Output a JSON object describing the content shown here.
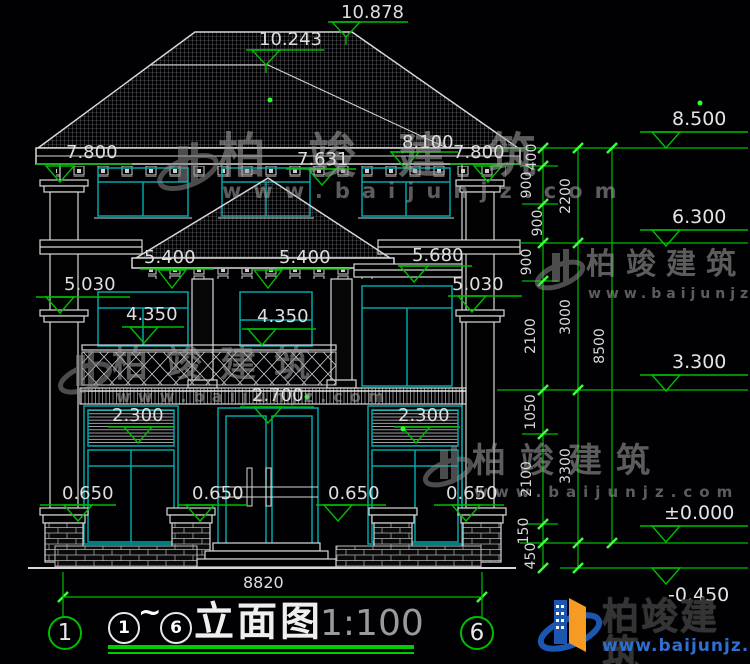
{
  "app": {
    "type": "architectural elevation CAD drawing",
    "background": "#010104"
  },
  "colors": {
    "line_white": "#d8d8d8",
    "window_frame_cyan": "#00a8a8",
    "dimension_green": "#00bd00",
    "tick_green": "#3aff3a",
    "label_white": "#dedede",
    "scale_gray": "#9a9a9a",
    "watermark_gray": "#9e9e9e",
    "logo_blue": "#1b57b0",
    "logo_orange": "#f59a23",
    "logo_url_blue": "#2e6fd0"
  },
  "marks": {
    "ridge_top": "10.878",
    "ridge_secondary": "10.243",
    "eave_left": "7.800",
    "eave_top": "8.100",
    "eave_right": "7.800",
    "porch_peak": "7.631",
    "porch_eave_left": "5.400",
    "porch_eave_right": "5.400",
    "bay_ledge": "5.680",
    "floor2_left": "5.030",
    "floor2_right": "5.030",
    "sill2_left": "4.350",
    "sill2_center": "4.350",
    "balcony": "2.700",
    "louver_left": "2.300",
    "louver_right": "2.300",
    "sill1_1": "0.650",
    "sill1_2": "0.650",
    "sill1_3": "0.650",
    "sill1_4": "0.650",
    "overall_width": "8820"
  },
  "right_dims": {
    "inner": [
      "400",
      "900",
      "900",
      "900",
      "2100",
      "1050",
      "2100",
      "150",
      "450"
    ],
    "mid": [
      "2200",
      "3000",
      "3300"
    ],
    "outer": [
      "8500"
    ],
    "levels": [
      "8.500",
      "6.300",
      "3.300",
      "±0.000",
      "-0.450"
    ]
  },
  "titleblock": {
    "axis_left": "1",
    "axis_right": "6",
    "circ_start": "1",
    "tilde": "~",
    "circ_end": "6",
    "title": "立面图",
    "scale": "1:100"
  },
  "watermark": {
    "brand": "柏竣建筑",
    "url": "www.baijunjz.com"
  },
  "logo": {
    "brand": "柏竣建筑",
    "url": "www.baijunjz.com"
  }
}
